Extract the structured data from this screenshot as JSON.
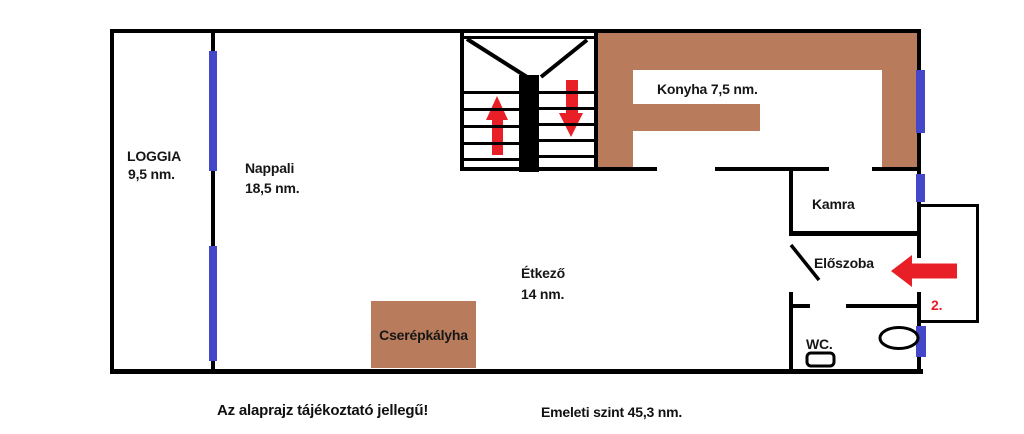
{
  "rooms": {
    "loggia": {
      "label": "LOGGIA",
      "area": "9,5 nm."
    },
    "nappali": {
      "label": "Nappali",
      "area": "18,5 nm."
    },
    "konyha": {
      "label": "Konyha 7,5 nm."
    },
    "kamra": {
      "label": "Kamra"
    },
    "eloszoba": {
      "label": "Előszoba"
    },
    "etkezo": {
      "label": "Étkező",
      "area": "14 nm."
    },
    "wc": {
      "label": "WC."
    }
  },
  "fixtures": {
    "stove": {
      "label": "Cserépkályha"
    },
    "basin": {
      "icon": "oval-basin"
    },
    "toilet": {
      "icon": "toilet-cistern"
    }
  },
  "stairs": {
    "up_arrow_icon": "stairs-up-arrow",
    "down_arrow_icon": "stairs-down-arrow"
  },
  "entrance": {
    "number": "2.",
    "arrow_icon": "entrance-left-arrow"
  },
  "footer": {
    "disclaimer": "Az alaprajz tájékoztató jellegű!",
    "level_summary": "Emeleti szint 45,3 nm."
  },
  "colors": {
    "wall": "#000000",
    "window": "#4347c8",
    "counter": "#b87c5c",
    "arrow": "#e81f27"
  }
}
